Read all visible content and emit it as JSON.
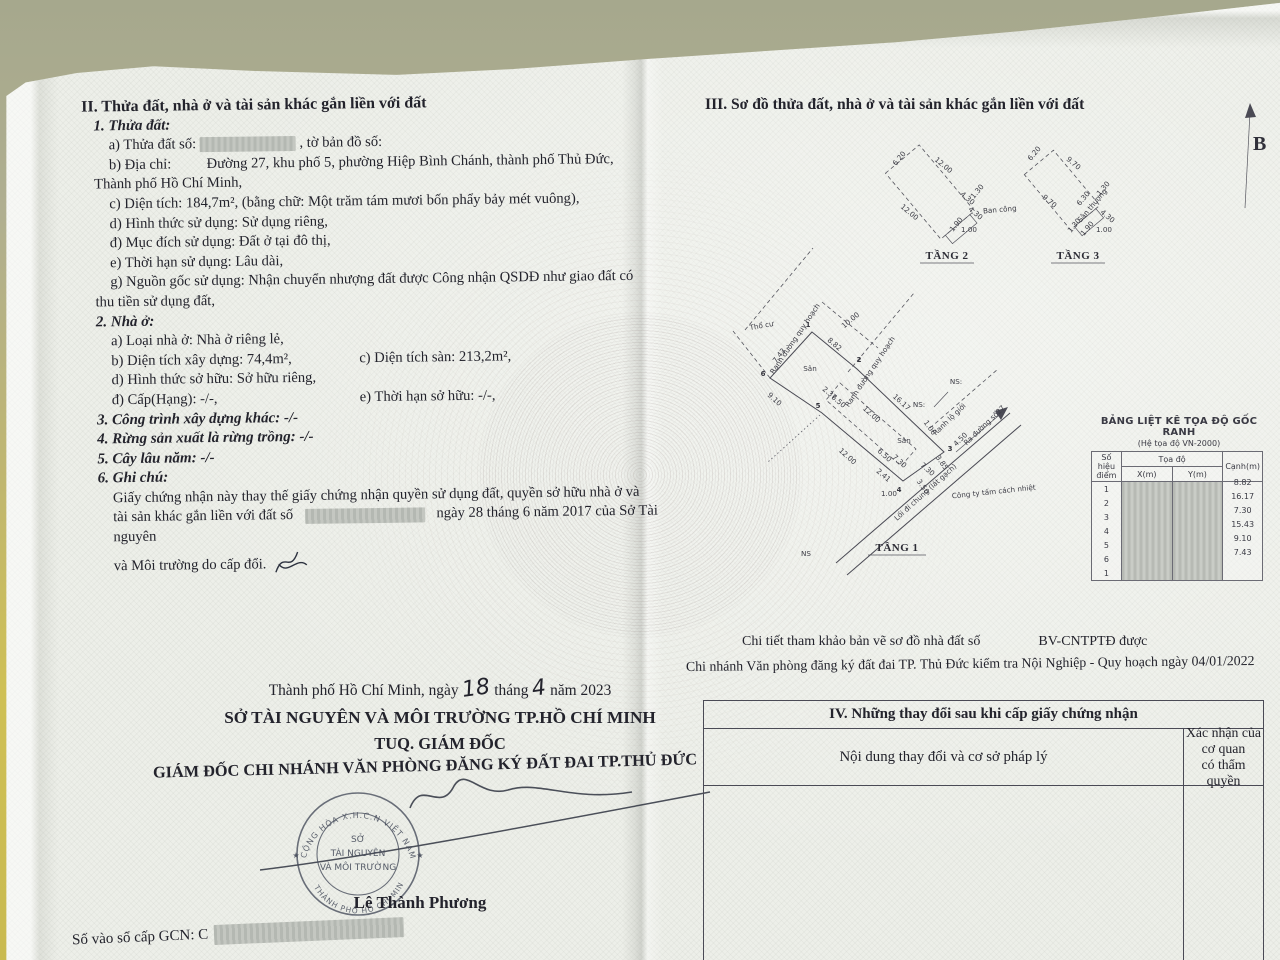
{
  "left": {
    "heading": "II. Thửa đất, nhà ở và tài sản khác gắn liền với đất",
    "thua_dat": {
      "title": "1. Thửa đất:",
      "a_label": "a) Thửa đất số:",
      "a_tail": ", tờ bản đồ số:",
      "b_label": "b) Địa chỉ:",
      "b_value": "Đường 27, khu phố 5, phường Hiệp Bình Chánh, thành phố Thủ Đức,",
      "b_value2": "Thành phố Hồ Chí Minh,",
      "c": "c) Diện tích: 184,7m², (bằng chữ: Một trăm tám mươi bốn phẩy bảy mét vuông),",
      "d": "d) Hình thức sử dụng: Sử dụng riêng,",
      "dd": "đ) Mục đích sử dụng: Đất ở tại đô thị,",
      "e": "e) Thời hạn sử dụng: Lâu dài,",
      "g1": "g) Nguồn gốc sử dụng: Nhận chuyển nhượng đất được Công nhận QSDĐ như giao đất có",
      "g2": "thu tiền sử dụng đất,"
    },
    "nha_o": {
      "title": "2. Nhà ở:",
      "a": "a) Loại nhà ở: Nhà ở riêng lẻ,",
      "b": "b) Diện tích xây dựng: 74,4m²,",
      "c": "c) Diện tích sàn: 213,2m²,",
      "d": "d) Hình thức sở hữu: Sở hữu riêng,",
      "dd": "đ) Cấp(Hạng): -/-,",
      "e": "e) Thời hạn sở hữu: -/-,"
    },
    "item3": "3. Công trình xây dựng khác: -/-",
    "item4": "4. Rừng sản xuất là rừng trồng: -/-",
    "item5": "5. Cây lâu năm: -/-",
    "ghi_chu_title": "6. Ghi chú:",
    "ghi_chu1": "Giấy chứng nhận này thay thế giấy chứng nhận quyền sử dụng đất, quyền sở hữu nhà ở và",
    "ghi_chu2a": "tài sản khác gắn liền với đất số",
    "ghi_chu2b": "ngày 28 tháng 6 năm 2017 của Sở Tài nguyên",
    "ghi_chu3": "và Môi trường do cấp đổi.",
    "sign": {
      "date_pre": "Thành phố Hồ Chí Minh, ngày",
      "day": "18",
      "mid": "tháng",
      "month": "4",
      "post": "năm 2023",
      "line1": "SỞ TÀI NGUYÊN VÀ MÔI TRƯỜNG TP.HỒ CHÍ MINH",
      "line2": "TUQ. GIÁM ĐỐC",
      "line3": "GIÁM ĐỐC CHI NHÁNH VĂN PHÒNG ĐĂNG KÝ ĐẤT ĐAI TP.THỦ ĐỨC",
      "name": "Lê Thành Phương",
      "stamp_top": "CỘNG HÒA X.H.C.N VIỆT NAM",
      "stamp_bottom": "THÀNH PHỐ HỒ CHÍ MINH",
      "stamp_c1": "SỞ",
      "stamp_c2": "TÀI NGUYÊN",
      "stamp_c3": "VÀ MÔI TRƯỜNG",
      "star": "★"
    },
    "so_vao_so": "Số vào sổ cấp GCN: C"
  },
  "right": {
    "heading": "III. Sơ đồ thửa đất, nhà ở và tài sản khác gắn liền với đất",
    "north_label": "B",
    "floor1_label": "TẦNG 1",
    "floor2_label": "TẦNG 2",
    "floor3_label": "TẦNG 3",
    "note1a": "Chi tiết tham khảo bản vẽ sơ đồ nhà đất số",
    "note1b": "BV-CNTPTĐ được",
    "note2": "Chi nhánh Văn phòng đăng ký đất đai TP. Thủ Đức  kiểm tra Nội Nghiệp - Quy hoạch  ngày 04/01/2022",
    "coord_table": {
      "title": "BẢNG LIỆT KÊ TỌA ĐỘ GỐC RANH",
      "subtitle": "(Hệ tọa độ VN-2000)",
      "col_point1": "Số hiệu",
      "col_point2": "điểm",
      "col_coord": "Tọa độ",
      "col_x": "X(m)",
      "col_y": "Y(m)",
      "col_edge": "Cạnh(m)",
      "points": [
        "1",
        "2",
        "3",
        "4",
        "5",
        "6",
        "1"
      ],
      "edges": [
        "8.82",
        "16.17",
        "7.30",
        "15.43",
        "9.10",
        "7.43",
        ""
      ]
    },
    "floor1_labels": [
      {
        "t": "Thổ cư",
        "x": 762,
        "y": 328,
        "r": -10
      },
      {
        "t": "Ranh đường quy hoạch",
        "x": 797,
        "y": 340,
        "r": -56
      },
      {
        "t": "Ranh đường quy hoạch",
        "x": 872,
        "y": 373,
        "r": -56
      },
      {
        "t": "10.00",
        "x": 852,
        "y": 322,
        "r": -40
      },
      {
        "t": "8.82",
        "x": 833,
        "y": 346,
        "r": 40
      },
      {
        "t": "7.43",
        "x": 781,
        "y": 357,
        "r": -52
      },
      {
        "t": "2.37",
        "x": 828,
        "y": 395,
        "r": 40
      },
      {
        "t": "6.50",
        "x": 837,
        "y": 403,
        "r": 40
      },
      {
        "t": "12.00",
        "x": 870,
        "y": 416,
        "r": 42
      },
      {
        "t": "16.17",
        "x": 900,
        "y": 404,
        "r": 42
      },
      {
        "t": "NS:",
        "x": 919,
        "y": 407,
        "r": 0
      },
      {
        "t": "NS:",
        "x": 956,
        "y": 384,
        "r": 0
      },
      {
        "t": "1.06",
        "x": 928,
        "y": 429,
        "r": 55
      },
      {
        "t": "Ranh lộ giới",
        "x": 951,
        "y": 421,
        "r": -44
      },
      {
        "t": "Ra đường số27",
        "x": 986,
        "y": 427,
        "r": -44
      },
      {
        "t": "4.50",
        "x": 962,
        "y": 441,
        "r": -44
      },
      {
        "t": "Sân",
        "x": 810,
        "y": 371,
        "r": 0
      },
      {
        "t": "Sân",
        "x": 904,
        "y": 443,
        "r": 0
      },
      {
        "t": "9.10",
        "x": 773,
        "y": 401,
        "r": 42
      },
      {
        "t": "12.00",
        "x": 846,
        "y": 458,
        "r": 42
      },
      {
        "t": "6.50",
        "x": 883,
        "y": 457,
        "r": 42
      },
      {
        "t": "7.30",
        "x": 898,
        "y": 463,
        "r": 42
      },
      {
        "t": "7.30",
        "x": 926,
        "y": 471,
        "r": 42
      },
      {
        "t": "2.41",
        "x": 882,
        "y": 477,
        "r": 40
      },
      {
        "t": "1.00",
        "x": 889,
        "y": 496,
        "r": 0
      },
      {
        "t": "3.50",
        "x": 921,
        "y": 488,
        "r": 55
      },
      {
        "t": "3.85",
        "x": 940,
        "y": 464,
        "r": 55
      },
      {
        "t": "Lối đi chung (lát gạch)",
        "x": 927,
        "y": 494,
        "r": -42
      },
      {
        "t": "Công ty tấm cách nhiệt",
        "x": 994,
        "y": 494,
        "r": -6
      },
      {
        "t": "NS",
        "x": 806,
        "y": 556,
        "r": 0
      },
      {
        "t": "1",
        "x": 808,
        "y": 327,
        "r": 0,
        "c": "vtx"
      },
      {
        "t": "2",
        "x": 859,
        "y": 362,
        "r": 0,
        "c": "vtx"
      },
      {
        "t": "3",
        "x": 950,
        "y": 451,
        "r": 0,
        "c": "vtx"
      },
      {
        "t": "4",
        "x": 899,
        "y": 492,
        "r": 0,
        "c": "vtx"
      },
      {
        "t": "5",
        "x": 818,
        "y": 408,
        "r": 0,
        "c": "vtx"
      },
      {
        "t": "6",
        "x": 763,
        "y": 376,
        "r": 0,
        "c": "vtx"
      }
    ],
    "floor2_labels": [
      {
        "t": "6.20",
        "x": 901,
        "y": 160,
        "r": -50
      },
      {
        "t": "12.00",
        "x": 942,
        "y": 167,
        "r": 40
      },
      {
        "t": "12.00",
        "x": 908,
        "y": 214,
        "r": 40
      },
      {
        "t": "4.30",
        "x": 966,
        "y": 200,
        "r": 40
      },
      {
        "t": "4.30",
        "x": 974,
        "y": 215,
        "r": 40
      },
      {
        "t": "1.30",
        "x": 979,
        "y": 193,
        "r": -50
      },
      {
        "t": "1.90",
        "x": 958,
        "y": 226,
        "r": -50
      },
      {
        "t": "1.00",
        "x": 969,
        "y": 232,
        "r": 0
      },
      {
        "t": "Ban công",
        "x": 1000,
        "y": 212,
        "r": -5
      }
    ],
    "floor3_labels": [
      {
        "t": "6.20",
        "x": 1036,
        "y": 155,
        "r": -50
      },
      {
        "t": "9.70",
        "x": 1072,
        "y": 165,
        "r": 40
      },
      {
        "t": "9.70",
        "x": 1048,
        "y": 203,
        "r": 40
      },
      {
        "t": "6.30",
        "x": 1085,
        "y": 200,
        "r": -50
      },
      {
        "t": "Sân thượng",
        "x": 1094,
        "y": 207,
        "r": -50
      },
      {
        "t": "1.30",
        "x": 1105,
        "y": 190,
        "r": -50
      },
      {
        "t": "4.30",
        "x": 1106,
        "y": 218,
        "r": 40
      },
      {
        "t": "1.30",
        "x": 1076,
        "y": 227,
        "r": -50
      },
      {
        "t": "1.90",
        "x": 1089,
        "y": 230,
        "r": -50
      },
      {
        "t": "1.00",
        "x": 1104,
        "y": 232,
        "r": 0
      }
    ]
  },
  "section4": {
    "title": "IV. Những thay đổi sau khi cấp giấy chứng nhận",
    "col1": "Nội dung thay đổi và cơ sở pháp lý",
    "col2a": "Xác nhận của cơ quan",
    "col2b": "có thẩm quyền"
  }
}
